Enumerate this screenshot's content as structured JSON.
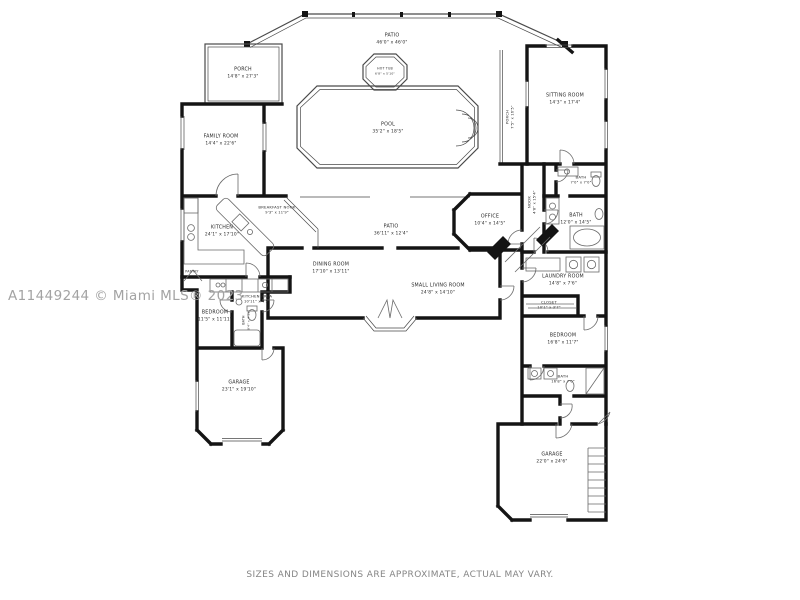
{
  "watermark": "A11449244 © Miami MLS® 2023",
  "disclaimer": "SIZES AND DIMENSIONS ARE APPROXIMATE, ACTUAL MAY VARY.",
  "colors": {
    "wall": "#141414",
    "thin_line": "#4a4a4a",
    "fixture_line": "#6a6a6a",
    "label": "#2b2b2b",
    "watermark": "#a3a3a3",
    "disclaimer": "#858585",
    "background": "#ffffff"
  },
  "rooms": [
    {
      "name": "PATIO",
      "dims": "46'0\" x 46'0\""
    },
    {
      "name": "HOT TUB",
      "dims": "6'8\" x 5'10\""
    },
    {
      "name": "POOL",
      "dims": "35'2\" x 18'5\""
    },
    {
      "name": "PORCH",
      "dims": "14'8\" x 27'3\""
    },
    {
      "name": "FAMILY ROOM",
      "dims": "14'4\" x 22'6\""
    },
    {
      "name": "BREAKFAST NOOK",
      "dims": "9'3\" x 11'9\""
    },
    {
      "name": "KITCHEN",
      "dims": "24'1\" x 17'10\""
    },
    {
      "name": "PATIO",
      "dims": "36'11\" x 12'4\""
    },
    {
      "name": "DINING ROOM",
      "dims": "17'10\" x 13'11\""
    },
    {
      "name": "SMALL LIVING ROOM",
      "dims": "24'8\" x 14'10\""
    },
    {
      "name": "OFFICE",
      "dims": "10'4\" x 14'5\""
    },
    {
      "name": "SITTING ROOM",
      "dims": "14'3\" x 17'4\""
    },
    {
      "name": "PORCH",
      "dims": "7'5\" x 16'5\""
    },
    {
      "name": "NOOK",
      "dims": "4'8\" x 15'4\""
    },
    {
      "name": "BATH",
      "dims": "7'0\" x 7'0\""
    },
    {
      "name": "BATH",
      "dims": "12'0\" x 14'5\""
    },
    {
      "name": "LAUNDRY ROOM",
      "dims": "14'8\" x 7'6\""
    },
    {
      "name": "CLOSET",
      "dims": "10'1\" x 3'7\""
    },
    {
      "name": "BEDROOM",
      "dims": "16'8\" x 11'7\""
    },
    {
      "name": "BATH",
      "dims": "16'8\" x 7'0\""
    },
    {
      "name": "GARAGE",
      "dims": "22'0\" x 24'6\""
    },
    {
      "name": "BEDROOM",
      "dims": "11'5\" x 11'11\""
    },
    {
      "name": "KITCHEN AREA",
      "dims": "10'11\" x 4'5\""
    },
    {
      "name": "BATH",
      "dims": "8'4\" x 4'11\""
    },
    {
      "name": "GARAGE",
      "dims": "23'1\" x 19'10\""
    },
    {
      "name": "PANTRY",
      "dims": ""
    }
  ]
}
